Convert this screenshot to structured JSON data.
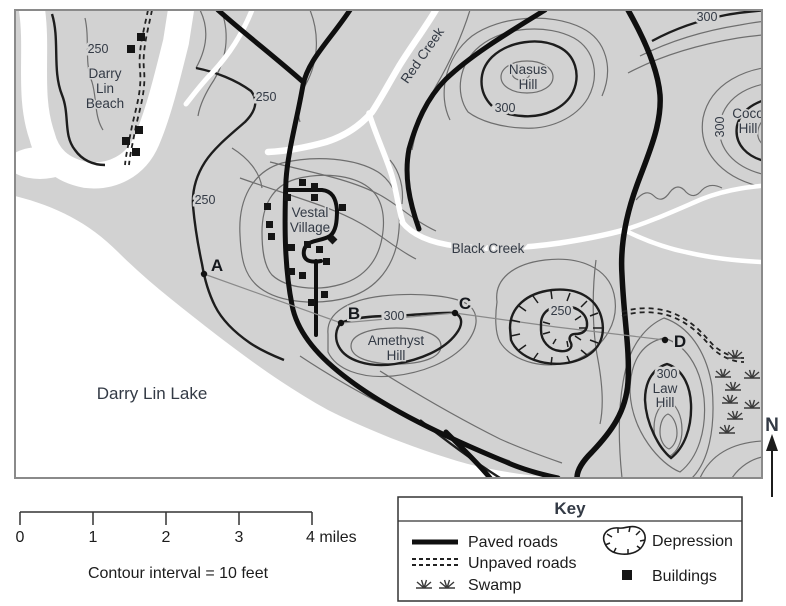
{
  "colors": {
    "land": "#d2d2d2",
    "water": "#ffffff",
    "road": "#0f0f0f",
    "thin_contour": "#6e6e6e",
    "index_contour": "#1d1d1d",
    "label_text": "#333a45"
  },
  "map": {
    "places": {
      "beach": [
        "Darry",
        "Lin",
        "Beach"
      ],
      "red_creek": "Red Creek",
      "nasus": [
        "Nasus",
        "Hill"
      ],
      "coco": [
        "Coco",
        "Hill"
      ],
      "vestal": [
        "Vestal",
        "Village"
      ],
      "black_creek": "Black Creek",
      "amethyst": [
        "Amethyst",
        "Hill"
      ],
      "lake": "Darry Lin Lake",
      "law": [
        "Law",
        "Hill"
      ]
    },
    "contour_labels": {
      "beach_250": "250",
      "west_250": "250",
      "village_250": "250",
      "nasus_300": "300",
      "north_300": "300",
      "coco_300": "300",
      "amethyst_300": "300",
      "law_300": "300",
      "depression_250": "250"
    },
    "points": {
      "a": "A",
      "b": "B",
      "c": "C",
      "d": "D"
    },
    "compass_north": "N"
  },
  "scale_bar": {
    "ticks": [
      "0",
      "1",
      "2",
      "3"
    ],
    "end_label": "4 miles",
    "note": "Contour interval = 10 feet"
  },
  "key": {
    "title": "Key",
    "paved": "Paved roads",
    "unpaved": "Unpaved roads",
    "swamp": "Swamp",
    "depression": "Depression",
    "buildings": "Buildings"
  }
}
